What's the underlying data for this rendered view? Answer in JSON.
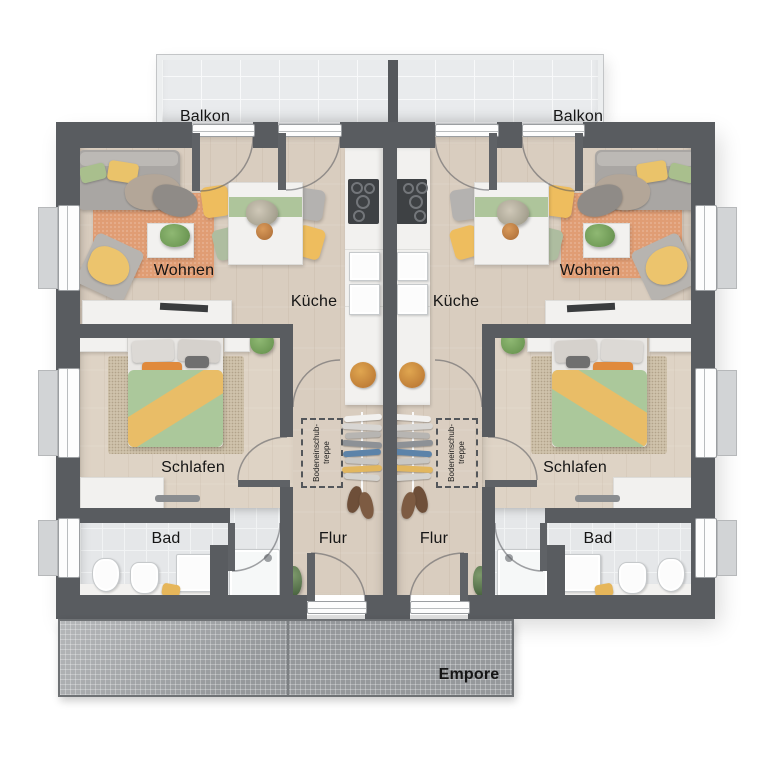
{
  "plan": {
    "type": "floor-plan",
    "description": "Top-down rendered floor plan, upper storey of a duplex with two mirrored apartment units and rear balcony"
  },
  "rooms": {
    "balkon_left": {
      "label": "Balkon"
    },
    "balkon_right": {
      "label": "Balkon"
    },
    "wohnen_left": {
      "label": "Wohnen"
    },
    "wohnen_right": {
      "label": "Wohnen"
    },
    "kueche_left": {
      "label": "Küche"
    },
    "kueche_right": {
      "label": "Küche"
    },
    "schlafen_left": {
      "label": "Schlafen"
    },
    "schlafen_right": {
      "label": "Schlafen"
    },
    "bad_left": {
      "label": "Bad"
    },
    "bad_right": {
      "label": "Bad"
    },
    "flur_left": {
      "label": "Flur"
    },
    "flur_right": {
      "label": "Flur"
    },
    "empore": {
      "label": "Empore"
    }
  },
  "annotations": {
    "stairs_left": {
      "line1": "Bodeneinschub-",
      "line2": "treppe"
    },
    "stairs_right": {
      "line1": "Bodeneinschub-",
      "line2": "treppe"
    }
  },
  "colors": {
    "wall": "#595c60",
    "wood_floor": "#d9cdbf",
    "bedroom_floor": "#ded3c5",
    "bath_floor": "#e5e7e9",
    "balcony_floor": "#e9ebed",
    "living_rug": "#e09d74",
    "bedroom_rug": "#cfc2ab",
    "duvet_green": "#abc89b",
    "accent_yellow": "#e9bd67",
    "accent_orange": "#e08a3c",
    "empore_gray": "#95989b"
  }
}
